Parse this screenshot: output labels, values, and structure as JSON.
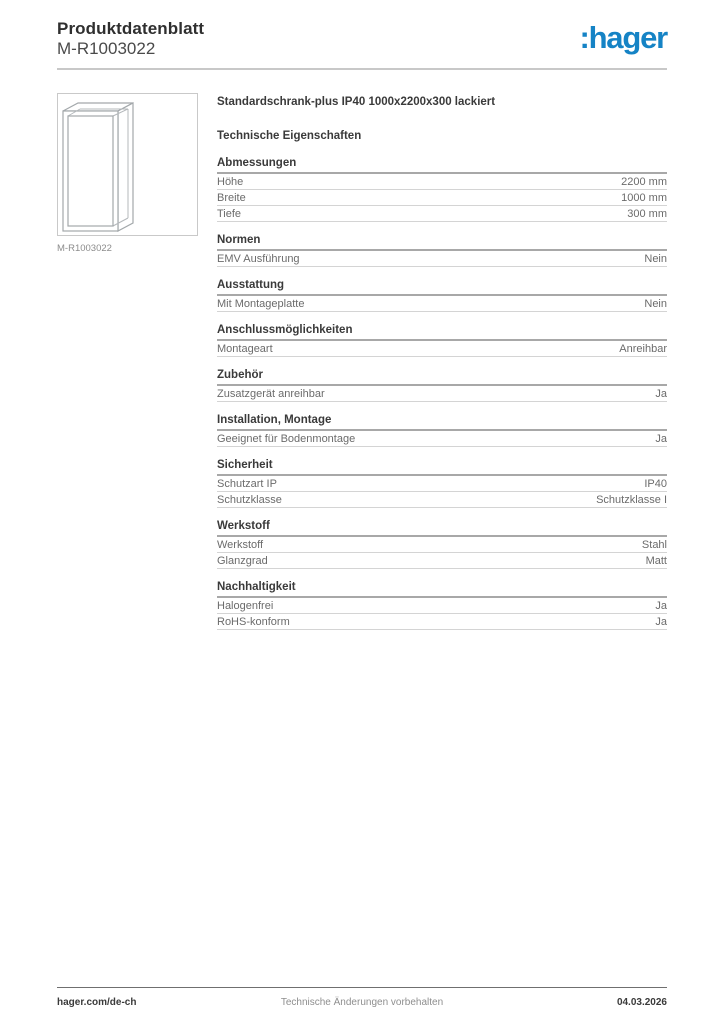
{
  "header": {
    "title": "Produktdatenblatt",
    "subtitle": "M-R1003022",
    "logo": ":hager"
  },
  "colors": {
    "brand_blue": "#1583c5"
  },
  "product": {
    "image_caption": "M-R1003022",
    "title": "Standardschrank-plus IP40 1000x2200x300 lackiert",
    "tech_title": "Technische Eigenschaften"
  },
  "sections": [
    {
      "title": "Abmessungen",
      "rows": [
        {
          "label": "Höhe",
          "value": "2200 mm"
        },
        {
          "label": "Breite",
          "value": "1000 mm"
        },
        {
          "label": "Tiefe",
          "value": "300 mm"
        }
      ]
    },
    {
      "title": "Normen",
      "rows": [
        {
          "label": "EMV Ausführung",
          "value": "Nein"
        }
      ]
    },
    {
      "title": "Ausstattung",
      "rows": [
        {
          "label": "Mit Montageplatte",
          "value": "Nein"
        }
      ]
    },
    {
      "title": "Anschlussmöglichkeiten",
      "rows": [
        {
          "label": "Montageart",
          "value": "Anreihbar"
        }
      ]
    },
    {
      "title": "Zubehör",
      "rows": [
        {
          "label": "Zusatzgerät anreihbar",
          "value": "Ja"
        }
      ]
    },
    {
      "title": "Installation, Montage",
      "rows": [
        {
          "label": "Geeignet für Bodenmontage",
          "value": "Ja"
        }
      ]
    },
    {
      "title": "Sicherheit",
      "rows": [
        {
          "label": "Schutzart IP",
          "value": "IP40"
        },
        {
          "label": "Schutzklasse",
          "value": "Schutzklasse I"
        }
      ]
    },
    {
      "title": "Werkstoff",
      "rows": [
        {
          "label": "Werkstoff",
          "value": "Stahl"
        },
        {
          "label": "Glanzgrad",
          "value": "Matt"
        }
      ]
    },
    {
      "title": "Nachhaltigkeit",
      "rows": [
        {
          "label": "Halogenfrei",
          "value": "Ja"
        },
        {
          "label": "RoHS-konform",
          "value": "Ja"
        }
      ]
    }
  ],
  "footer": {
    "left": "hager.com/de-ch",
    "center": "Technische Änderungen vorbehalten",
    "right": "04.03.2026"
  }
}
